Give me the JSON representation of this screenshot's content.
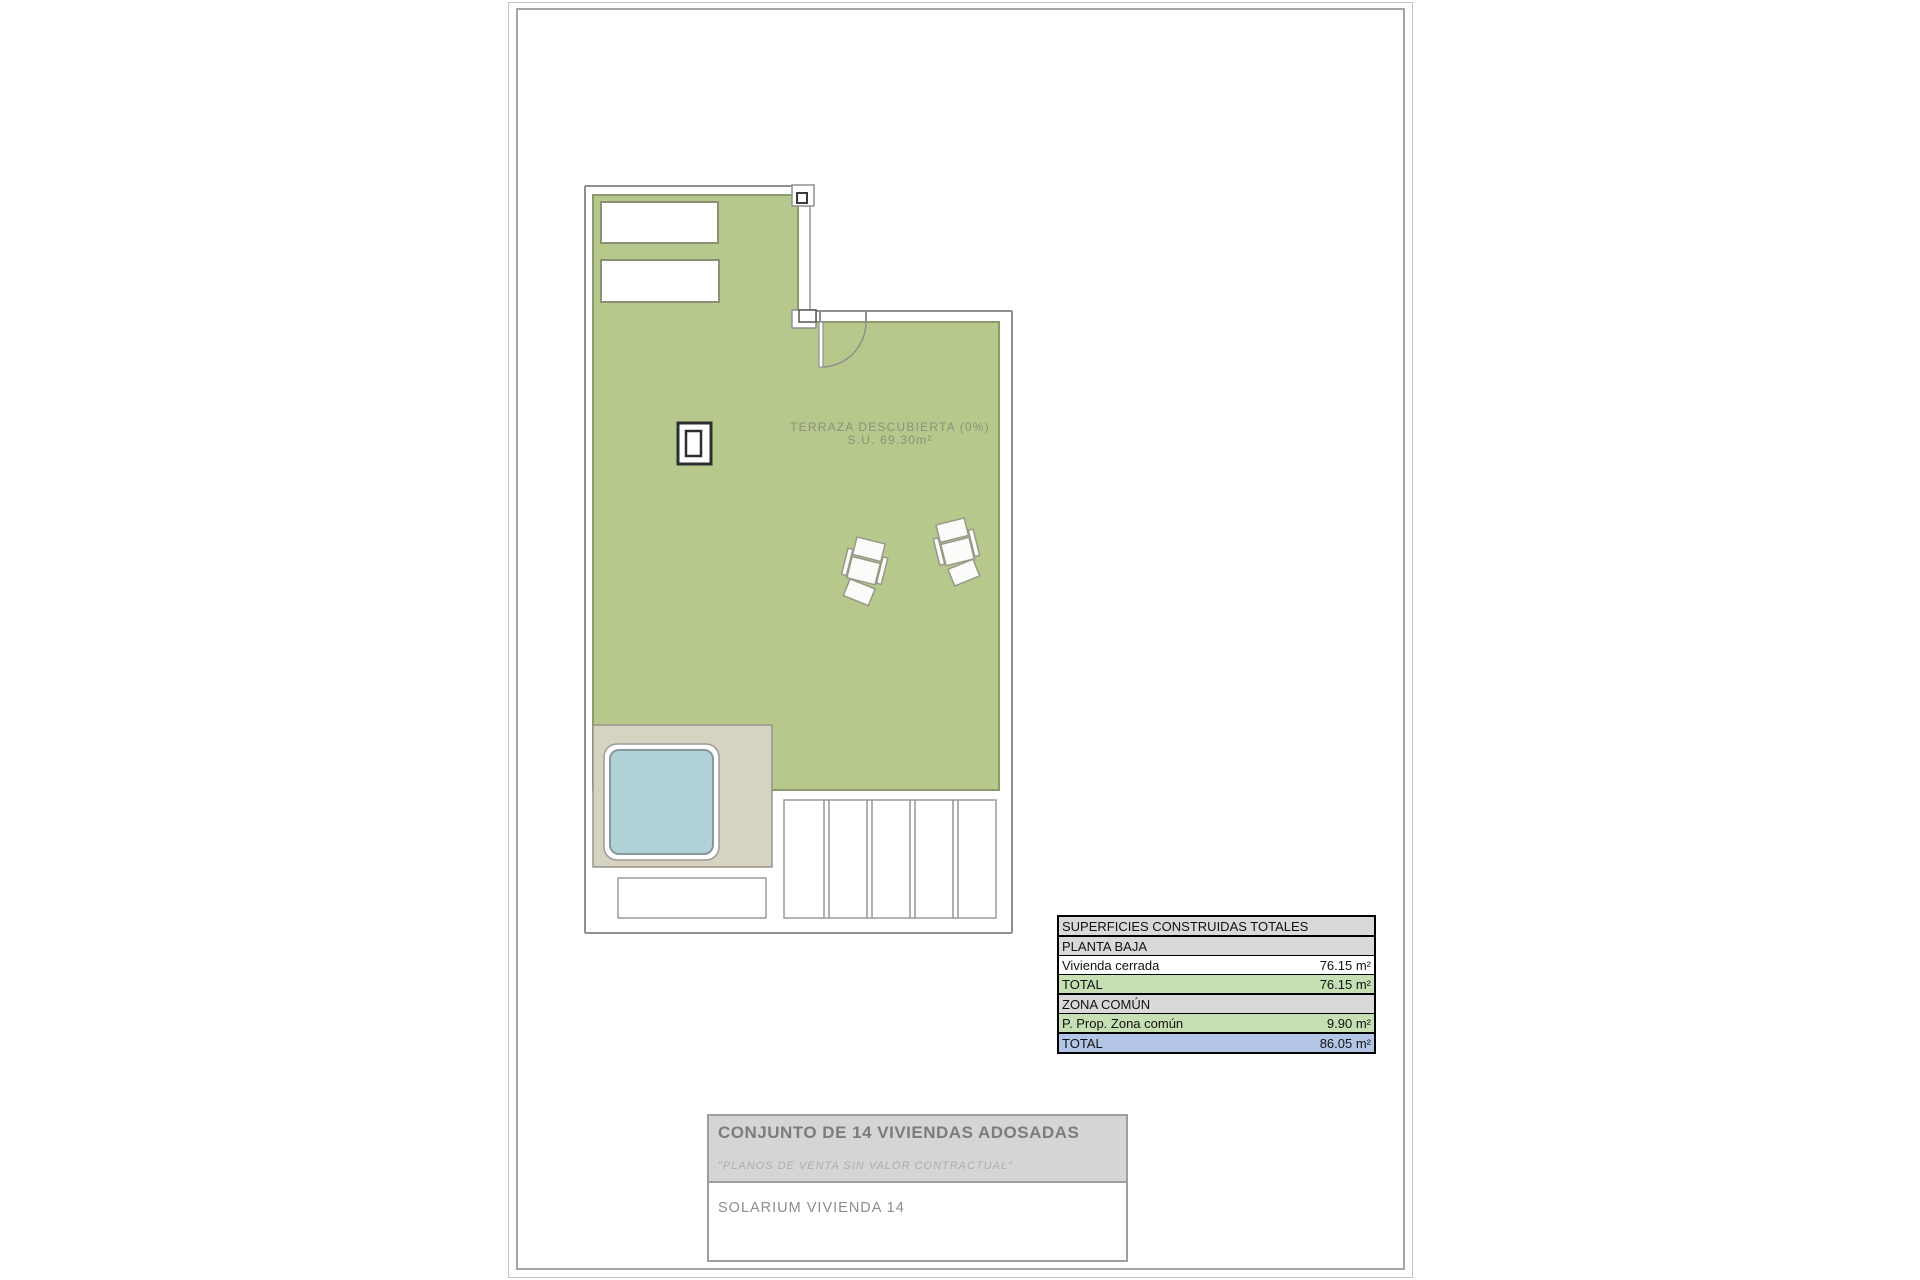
{
  "plan": {
    "terrace_label_line1": "TERRAZA DESCUBIERTA (0%)",
    "terrace_label_line2": "S.U. 69.30m²"
  },
  "areas_table": {
    "title": "SUPERFICIES CONSTRUIDAS TOTALES",
    "rows": [
      {
        "label": "PLANTA BAJA",
        "value": ""
      },
      {
        "label": "Vivienda cerrada",
        "value": "76.15 m²"
      },
      {
        "label": "TOTAL",
        "value": "76.15 m²"
      },
      {
        "label": "ZONA COMÚN",
        "value": ""
      },
      {
        "label": "P. Prop. Zona común",
        "value": "9.90 m²"
      },
      {
        "label": "TOTAL",
        "value": "86.05 m²"
      }
    ]
  },
  "title_block": {
    "project_title": "CONJUNTO DE 14 VIVIENDAS ADOSADAS",
    "disclaimer": "\"PLANOS DE VENTA SIN VALOR CONTRACTUAL\"",
    "sheet_name": "SOLARIUM VIVIENDA 14"
  },
  "colors": {
    "terrace_green": "#b6c88c",
    "terrace_edge": "#8d9a6e",
    "deck_beige": "#d7d3c3",
    "pool_blue": "#b0d2d6",
    "wall_gray": "#8f8f8f",
    "table_header_gray": "#d9d9d9",
    "table_green": "#c6e0b4",
    "table_blue": "#b4c6e7"
  }
}
